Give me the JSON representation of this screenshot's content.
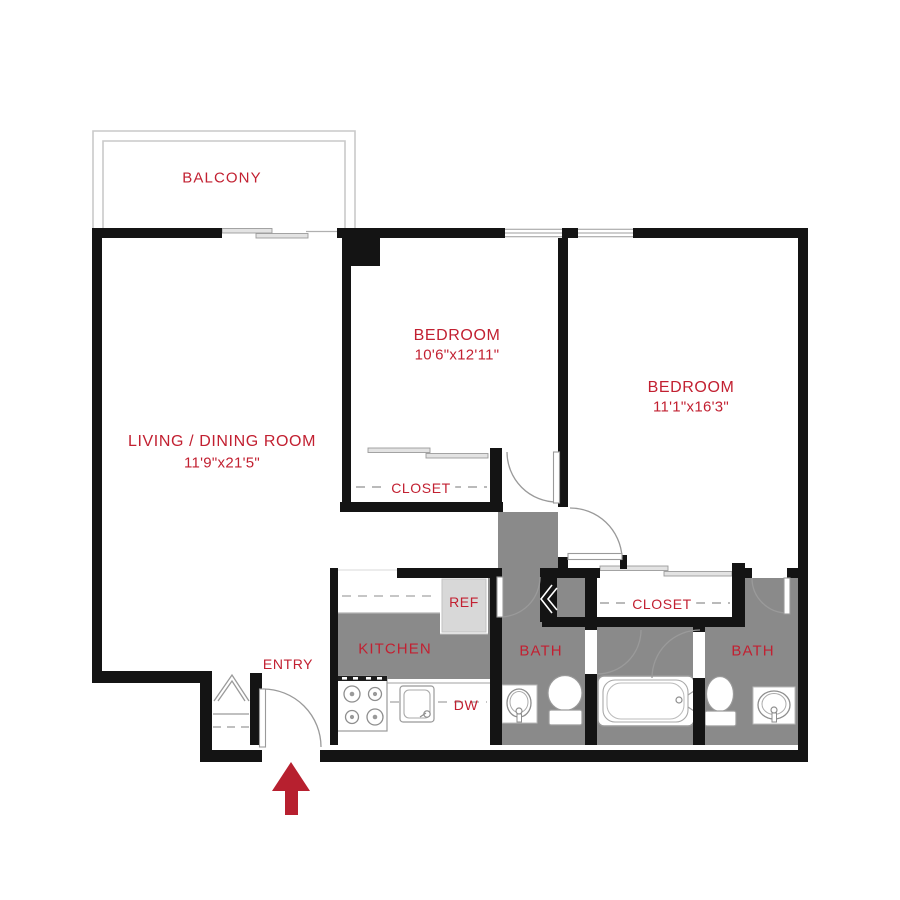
{
  "title": "Apartment floor plan",
  "colors": {
    "accent_red": "#c22031",
    "arrow_red": "#b7202f",
    "wall_black": "#141414",
    "floor_gray": "#8a8a8a",
    "appliance_gray": "#d8d8d8"
  },
  "rooms": {
    "balcony": {
      "label": "BALCONY"
    },
    "living": {
      "label": "LIVING / DINING ROOM",
      "dims": "11'9\"x21'5\""
    },
    "bedroom1": {
      "label": "BEDROOM",
      "dims": "10'6\"x12'11\""
    },
    "bedroom2": {
      "label": "BEDROOM",
      "dims": "11'1\"x16'3\""
    },
    "closet1": {
      "label": "CLOSET"
    },
    "closet2": {
      "label": "CLOSET"
    },
    "kitchen": {
      "label": "KITCHEN"
    },
    "bath1": {
      "label": "BATH"
    },
    "bath2": {
      "label": "BATH"
    },
    "entry": {
      "label": "ENTRY"
    }
  },
  "appliances": {
    "refrigerator": "REF",
    "dishwasher": "DW"
  }
}
